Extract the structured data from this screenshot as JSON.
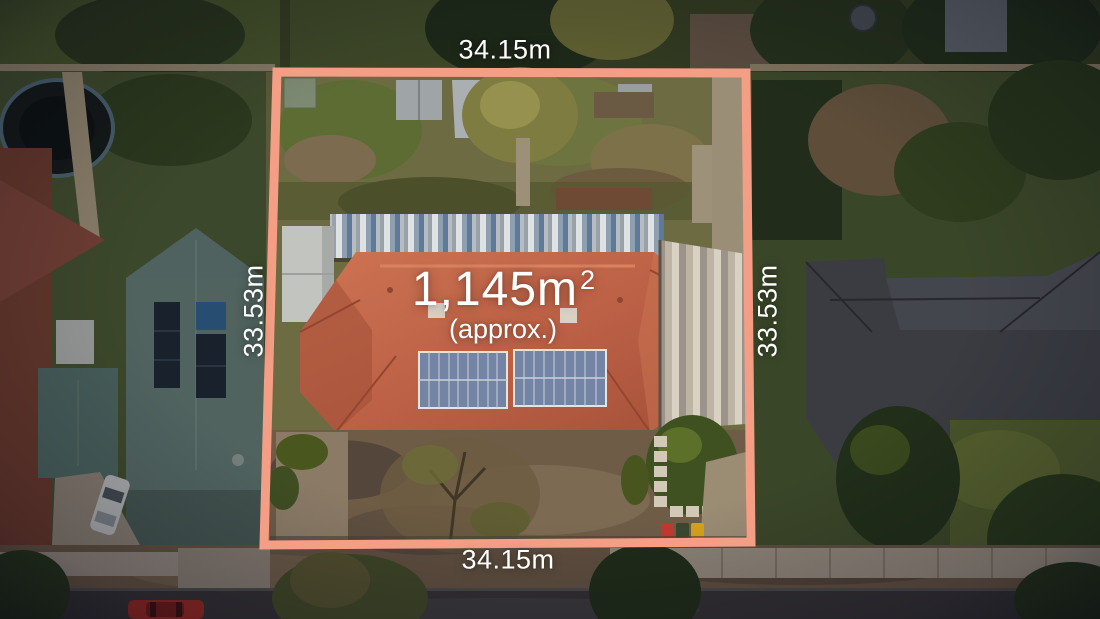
{
  "page": {
    "type": "aerial-property-photo"
  },
  "overlay": {
    "dimensions": {
      "top": "34.15m",
      "bottom": "34.15m",
      "left": "33.53m",
      "right": "33.53m"
    },
    "area": {
      "value": "1,145m",
      "superscript": "2",
      "qualifier": "(approx.)"
    },
    "boundary_color": "#F59E86",
    "label_color": "#FFFFFF"
  },
  "scene": {
    "colors": {
      "main_roof": "#BE6247",
      "main_roof_light": "#CD7453",
      "main_roof_dark": "#A5503A",
      "left_neighbor_roof": "#5F766F",
      "right_neighbor_roof": "#45474C",
      "solar_panels": "#7384A4",
      "grass": "#4C5C2C",
      "dirt": "#6F5C47",
      "road_asphalt": "#3A3839",
      "concrete_path": "#A79B8A",
      "red_car": "#A72F27",
      "white_car": "#C8CBCA",
      "bin_red": "#C13A31",
      "bin_green": "#39492F",
      "bin_yellow": "#D7A31D"
    }
  }
}
